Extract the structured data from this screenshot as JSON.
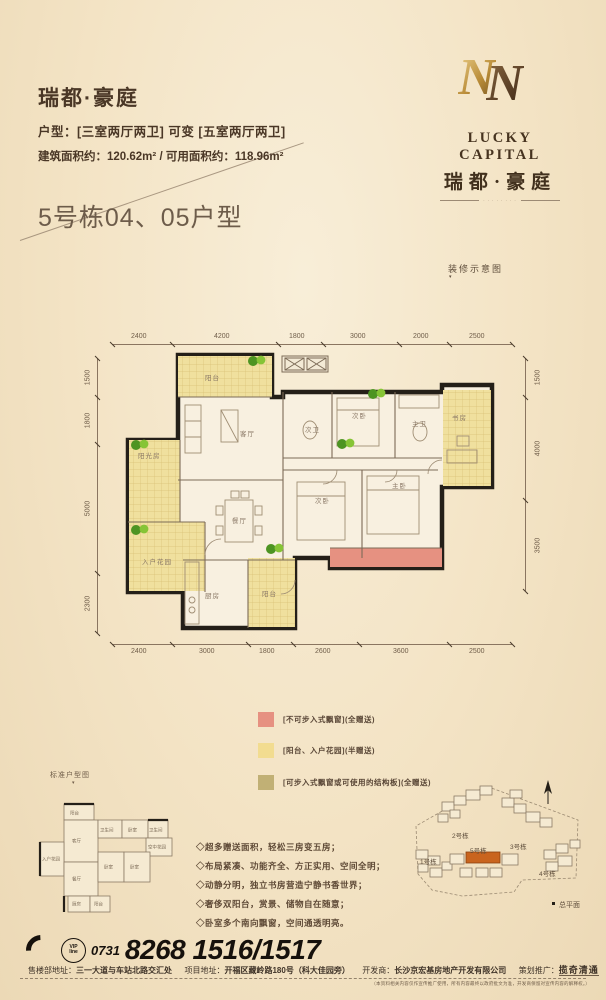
{
  "header": {
    "brand": "瑞都·豪庭",
    "unit_label": "户型：",
    "unit_opt1": "[三室两厅两卫]",
    "unit_mid": "可变",
    "unit_opt2": "[五室两厅两卫]",
    "area_label1": "建筑面积约：",
    "area_val1": "120.62m²",
    "area_sep": "/",
    "area_label2": "可用面积约：",
    "area_val2": "118.96m²"
  },
  "logo": {
    "en": "LUCKY CAPITAL",
    "cn": "瑞都·豪庭",
    "tagline": "· · · · · · · ·"
  },
  "section": {
    "title": "5号栋04、05户型",
    "deco_note": "装修示意图",
    "deco_arrow": "▾"
  },
  "plan": {
    "dims_top": [
      "2400",
      "4200",
      "1800",
      "3000",
      "2000",
      "2500"
    ],
    "dims_bottom": [
      "2400",
      "3000",
      "1800",
      "2600",
      "3600",
      "2500"
    ],
    "dims_left": [
      "1500",
      "1800",
      "5000",
      "2300"
    ],
    "dims_right": [
      "1500",
      "4000",
      "3500"
    ],
    "rooms": {
      "balcony_top": "阳台",
      "living": "客厅",
      "sunroom": "阳光房",
      "entry_garden": "入户花园",
      "dining": "餐厅",
      "kitchen": "厨房",
      "balcony_bottom": "阳台",
      "bath2": "次卫",
      "bed2a": "次卧",
      "master_bath": "主卫",
      "study": "书房",
      "bed2b": "次卧",
      "master_bed": "主卧"
    }
  },
  "legend": {
    "items": [
      {
        "label": "[不可步入式飘窗](全赠送)",
        "color": "#e69181"
      },
      {
        "label": "[阳台、入户花园](半赠送)",
        "color": "#f2dc90"
      },
      {
        "label": "[可步入式飘窗或可使用的结构板](全赠送)",
        "color": "#c1b075"
      }
    ]
  },
  "mini": {
    "caption": "标准户型图",
    "arrow": "▾",
    "rooms": [
      "阳台",
      "客厅",
      "卫生间",
      "卧室",
      "卫生间",
      "空中花园",
      "入户花园",
      "餐厅",
      "卧室",
      "卧室",
      "厨房",
      "阳台"
    ]
  },
  "features": [
    "◇超多赠送面积，轻松三房变五房；",
    "◇布局紧凑、功能齐全、方正实用、空间全明；",
    "◇动静分明，独立书房营造宁静书香世界；",
    "◇奢侈双阳台，赏景、储物自在随意；",
    "◇卧室多个南向飘窗，空间通透明亮。"
  ],
  "site": {
    "buildings": [
      "1号栋",
      "2号栋",
      "3号栋",
      "4号栋",
      "5号栋"
    ],
    "caption": "总平面"
  },
  "footer": {
    "vip_line1": "VIP",
    "vip_line2": "line",
    "area_code": "0731",
    "phone": "8268 1516/1517",
    "label1": "售楼部地址：",
    "val1": "三一大道与车站北路交汇处",
    "label2": "项目地址：",
    "val2": "开福区藏岭路180号（科大佳园旁）",
    "label3": "开发商：",
    "val3": "长沙京宏基房地产开发有限公司",
    "label4": "策划推广：",
    "agency": "揽奇清通",
    "disclaimer": "（本资料相关内容仅作宣传推广使用，所有内容最终以政府批文为准，开发商保留对宣传内容的解释权。）"
  },
  "colors": {
    "background": "#f3e4c6",
    "wall": "#241f18",
    "gold": "#b08d45",
    "accent_building": "#c9641e",
    "pink": "#e69181",
    "yellow": "#f2dc90",
    "khaki": "#c1b075",
    "text_brown": "#4a3726"
  }
}
